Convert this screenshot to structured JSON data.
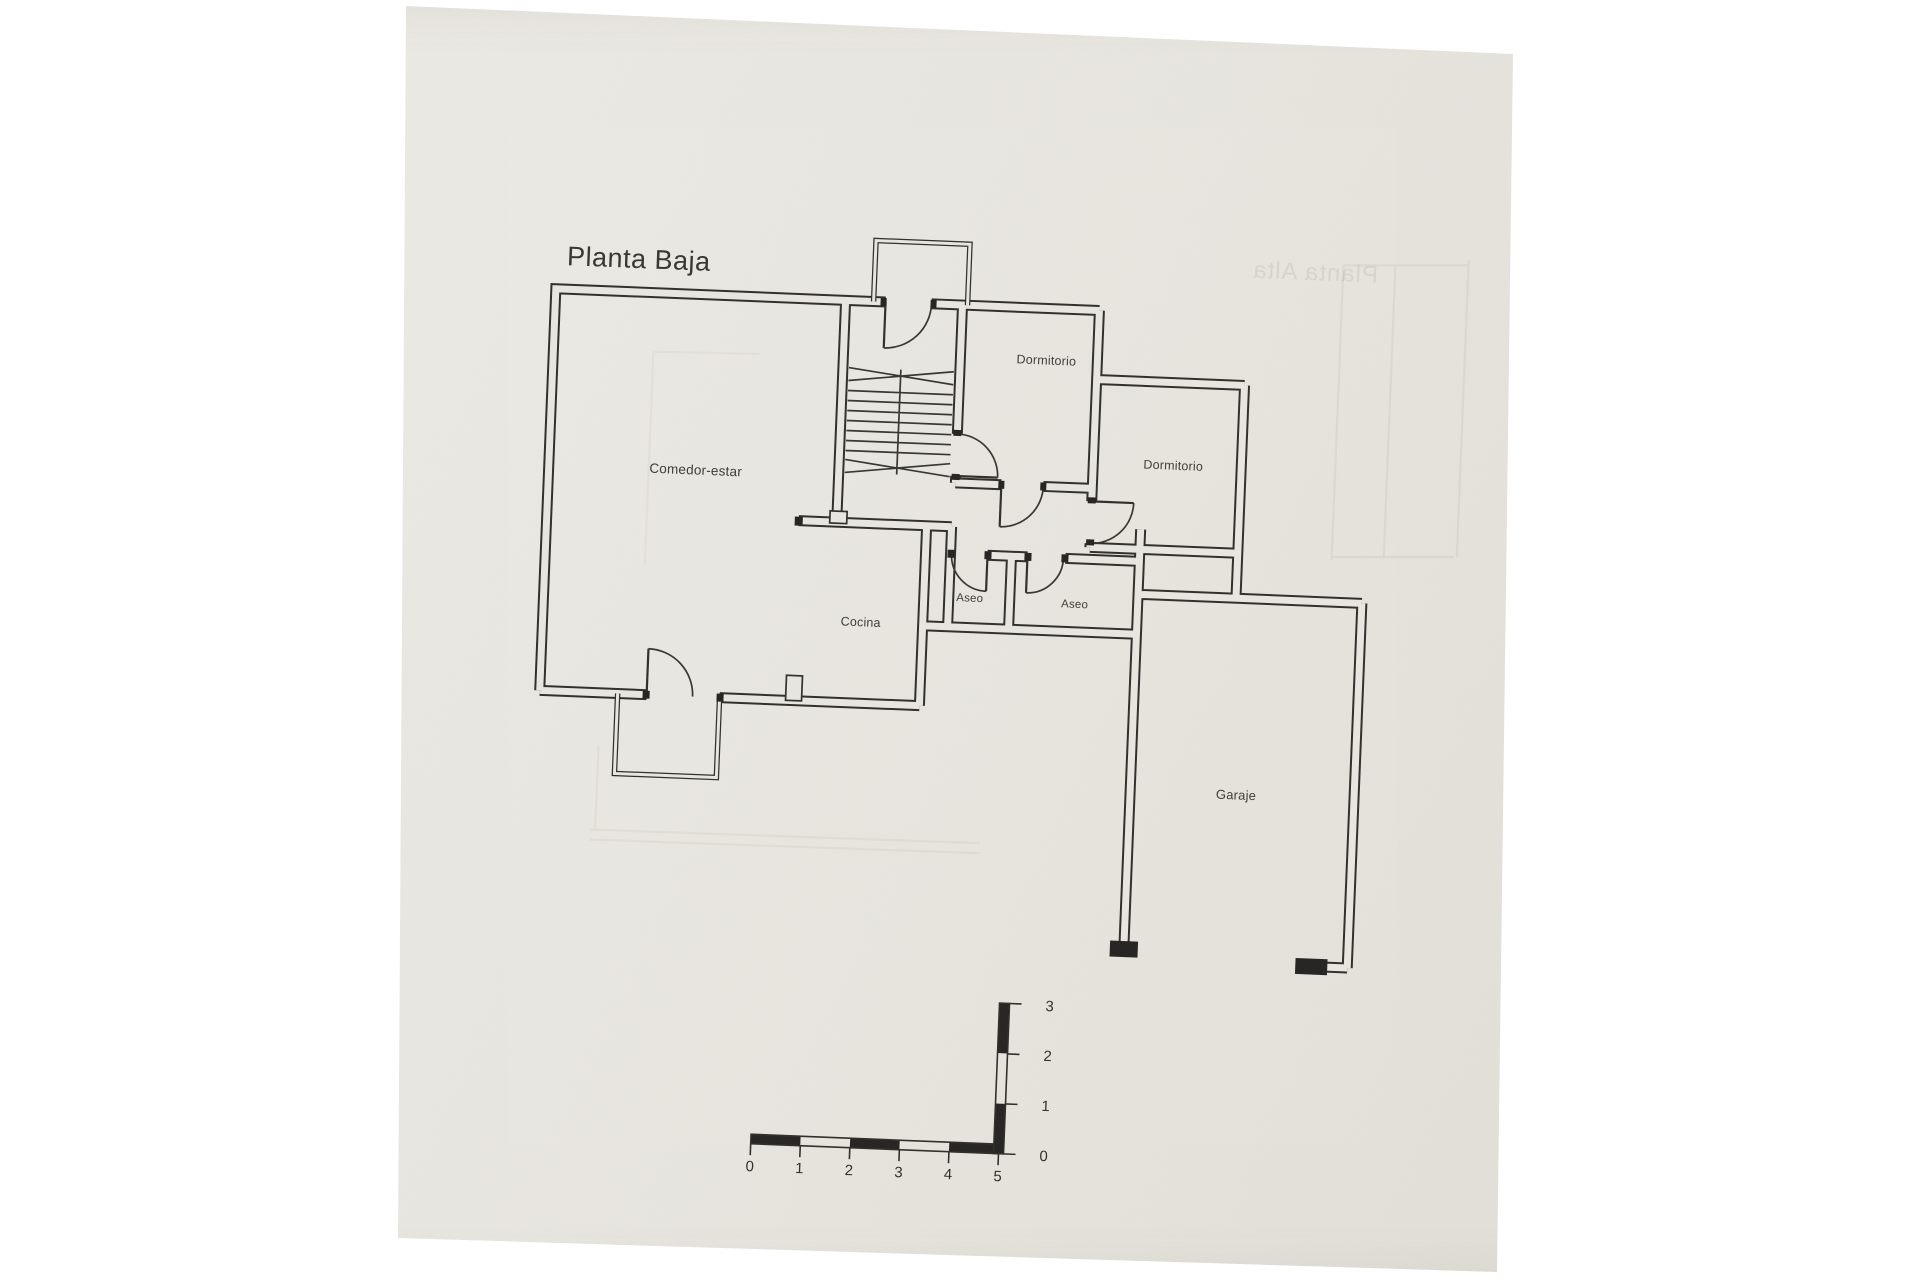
{
  "title": "Planta Baja",
  "rooms": {
    "comedor": "Comedor-estar",
    "dormitorio1": "Dormitorio",
    "dormitorio2": "Dormitorio",
    "cocina": "Cocina",
    "aseo1": "Aseo",
    "aseo2": "Aseo",
    "garaje": "Garaje"
  },
  "showthrough_text": "Planta Alta",
  "scalebar": {
    "h_labels": [
      "0",
      "1",
      "2",
      "3",
      "4",
      "5"
    ],
    "v_labels": [
      "0",
      "1",
      "2",
      "3"
    ]
  },
  "colors": {
    "paper": "#e9e7e1",
    "ink": "#2e2d29",
    "label_text": "#3b3a35",
    "faint_showthrough": "#8d8472",
    "canvas": "#ffffff"
  }
}
